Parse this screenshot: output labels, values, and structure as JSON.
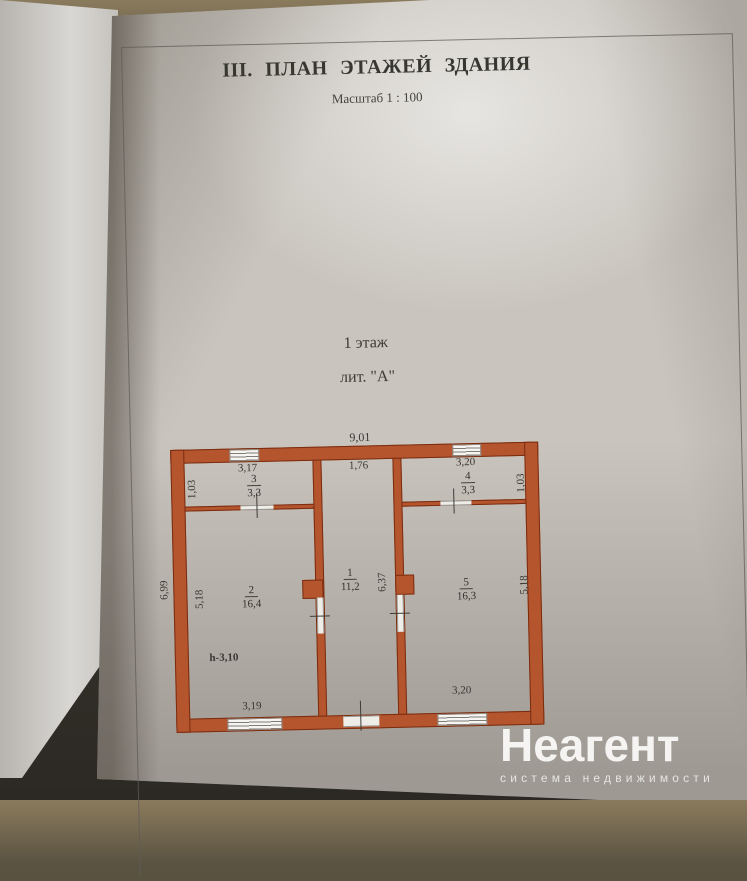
{
  "document": {
    "title": "III. ПЛАН ЭТАЖЕЙ ЗДАНИЯ",
    "scale": "Масштаб 1 : 100",
    "floor_label": "1 этаж",
    "liter_label": "лит. \"А\""
  },
  "plan": {
    "rooms": {
      "r1": {
        "number": "1",
        "area": "11,2"
      },
      "r2": {
        "number": "2",
        "area": "16,4"
      },
      "r3": {
        "number": "3",
        "area": "3,3"
      },
      "r4": {
        "number": "4",
        "area": "3,3"
      },
      "r5": {
        "number": "5",
        "area": "16,3"
      }
    },
    "dims": {
      "overall_top": "9,01",
      "corridor_top": "1,76",
      "room3_top": "3,17",
      "room4_top": "3,20",
      "room3_side": "1,03",
      "room4_side": "1,03",
      "left_outer": "6,99",
      "room2_side": "5,18",
      "room5_side": "5,18",
      "corridor_side": "6,37",
      "height_note": "h-3,10",
      "bottom_left": "3,19",
      "bottom_right": "3,20"
    }
  },
  "watermark": {
    "brand": "Неагент",
    "tagline": "система недвижимости"
  },
  "colors": {
    "wall": "#b4552e",
    "wall_outline": "#7a2c10",
    "paper": "#c9c5be"
  }
}
